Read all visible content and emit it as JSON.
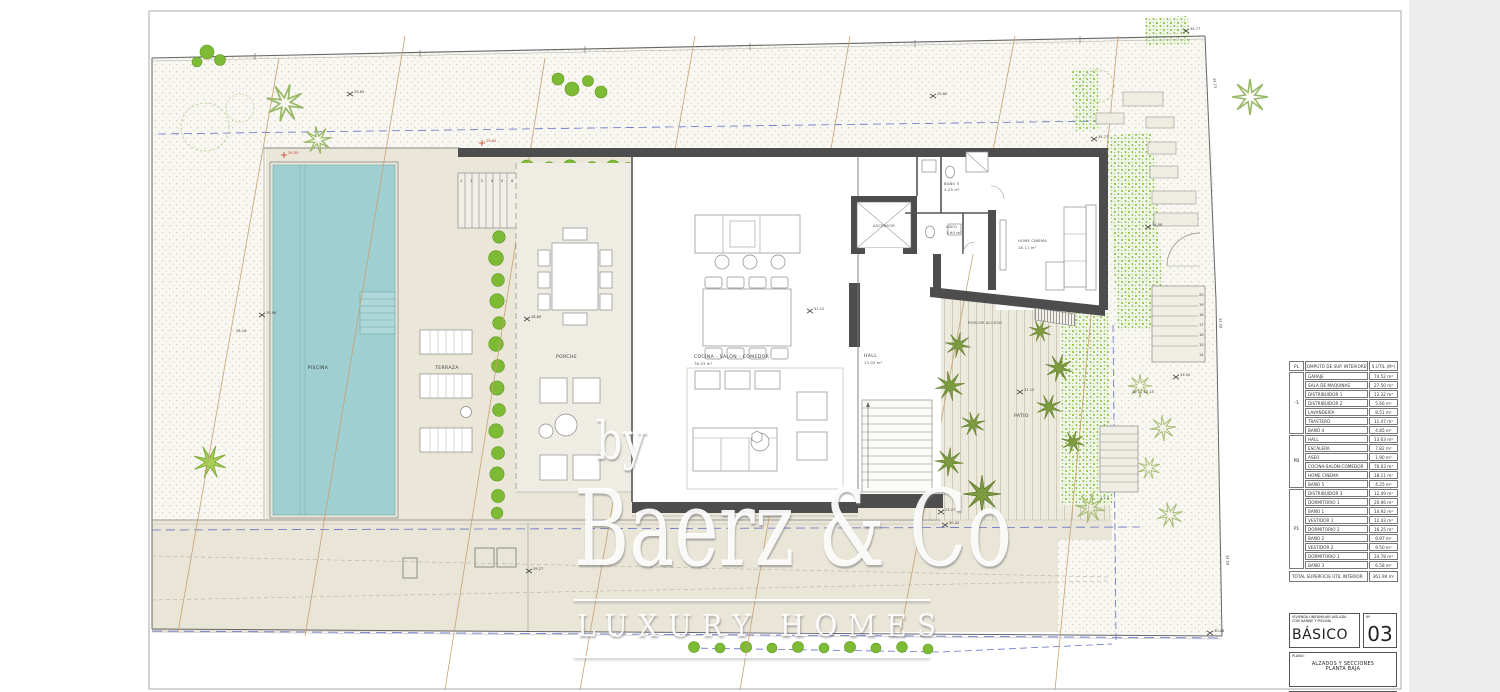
{
  "colors": {
    "pool_water": "#9fcfd1",
    "wall_dark": "#4d4d4d",
    "hedge_green": "#7cbb33",
    "palm_olive": "#7d9c3f",
    "contour_tan": "#c8a271",
    "setback_blue": "#6472c8",
    "marker_red": "#c0392b",
    "site_beige": "#eae6d8",
    "paper": "#ffffff"
  },
  "watermark": {
    "by": "by",
    "brand": "Baerz & Co",
    "tagline": "LUXURY HOMES"
  },
  "plan": {
    "labels": {
      "piscina": "PISCINA",
      "terraza": "TERRAZA",
      "porche": "PORCHE",
      "cocina": "COCINA - SALÓN - COMEDOR",
      "cocina_area": "76.03 m²",
      "hall": "HALL",
      "hall_area": "13.03 m²",
      "escalera": "ESCALERA",
      "ascensor": "ASCENSOR",
      "bano5": "BAÑO 5",
      "bano5_area": "4.25 m²",
      "aseo": "ASEO",
      "aseo_area": "1.90 m²",
      "home_cinema": "HOME CINEMA",
      "home_cinema_area": "18.11 m²",
      "porche_acceso": "PORCHE ACCESO",
      "patio": "PATIO"
    },
    "markers": [
      {
        "value": "29.60",
        "color": "dark"
      },
      {
        "value": "29.60",
        "color": "dark"
      },
      {
        "value": "29.96",
        "color": "dark"
      },
      {
        "value": "28.89",
        "color": "dark"
      },
      {
        "value": "31.12",
        "color": "dark"
      },
      {
        "value": "31.12",
        "color": "dark"
      },
      {
        "value": "34.77",
        "color": "dark"
      },
      {
        "value": "34.58",
        "color": "dark"
      },
      {
        "value": "33.50",
        "color": "dark"
      },
      {
        "value": "29.27",
        "color": "dark"
      },
      {
        "value": "30.28",
        "color": "dark"
      },
      {
        "value": "23.27",
        "color": "dark"
      },
      {
        "value": "30.42",
        "color": "dark"
      },
      {
        "value": "34.77",
        "color": "dark"
      },
      {
        "value": "29.35",
        "color": "red"
      },
      {
        "value": "29.62",
        "color": "red"
      }
    ],
    "contour_labels": [
      "28.16",
      "30.05"
    ],
    "edge_levels": [
      "34.73",
      "34.50",
      "34.58"
    ],
    "stairs_right": [
      "20",
      "19",
      "18",
      "17",
      "16",
      "15",
      "14"
    ],
    "stair_rows": {
      "top": "1 2 3 4 5 6 7 8",
      "bottom": "10  11  12  13",
      "patio": "1   2   3"
    }
  },
  "area_table": {
    "header": {
      "pl": "PL",
      "name": "COMPUTO DE SUP. INTERIORES",
      "area": "S.UTIL (M²)"
    },
    "groups": [
      {
        "label": "-1",
        "rooms": [
          {
            "name": "GARAJE",
            "area": "74.52 m²"
          },
          {
            "name": "SALA DE MAQUINAS",
            "area": "27.50 m²"
          },
          {
            "name": "DISTRIBUIDOR 1",
            "area": "12.32 m²"
          },
          {
            "name": "DISTRIBUIDOR 2",
            "area": "5.66 m²"
          },
          {
            "name": "LAVANDERÍA",
            "area": "8.51 m²"
          },
          {
            "name": "TRASTERO",
            "area": "11.47 m²"
          },
          {
            "name": "BAÑO 4",
            "area": "4.85 m²"
          }
        ]
      },
      {
        "label": "PB",
        "rooms": [
          {
            "name": "HALL",
            "area": "13.03 m²"
          },
          {
            "name": "ESCALERA",
            "area": "7.82 m²"
          },
          {
            "name": "ASEO",
            "area": "1.90 m²"
          },
          {
            "name": "COCINA-SALÓN-COMEDOR",
            "area": "76.03 m²"
          },
          {
            "name": "HOME CINEMA",
            "area": "18.11 m²"
          },
          {
            "name": "BAÑO 5",
            "area": "4.25 m²"
          }
        ]
      },
      {
        "label": "P1",
        "rooms": [
          {
            "name": "DISTRIBUIDOR 3",
            "area": "12.49 m²"
          },
          {
            "name": "DORMITORIO 1",
            "area": "20.06 m²"
          },
          {
            "name": "BAÑO 1",
            "area": "14.92 m²"
          },
          {
            "name": "VESTIDOR 1",
            "area": "12.43 m²"
          },
          {
            "name": "DORMITORIO 2",
            "area": "16.25 m²"
          },
          {
            "name": "BAÑO 2",
            "area": "6.97 m²"
          },
          {
            "name": "VESTIDOR 2",
            "area": "9.50 m²"
          },
          {
            "name": "DORMITORIO 3",
            "area": "24.78 m²"
          },
          {
            "name": "BAÑO 3",
            "area": "6.58 m²"
          }
        ]
      }
    ],
    "total_label": "TOTAL SUPERFICIE ÚTIL INTERIOR",
    "total_value": "361.94 m²"
  },
  "titleblock": {
    "project_line1": "VIVIENDA UNIFAMILIAR AISLADA",
    "project_line2": "CON GARAJE Y PISCINA",
    "phase": "BÁSICO",
    "num_label": "Nº",
    "num": "03",
    "plano_label": "PLANO:",
    "plano_line1": "ALZADOS Y SECCIONES",
    "plano_line2": "PLANTA BAJA",
    "situacion_label": "SITUACIÓN"
  }
}
